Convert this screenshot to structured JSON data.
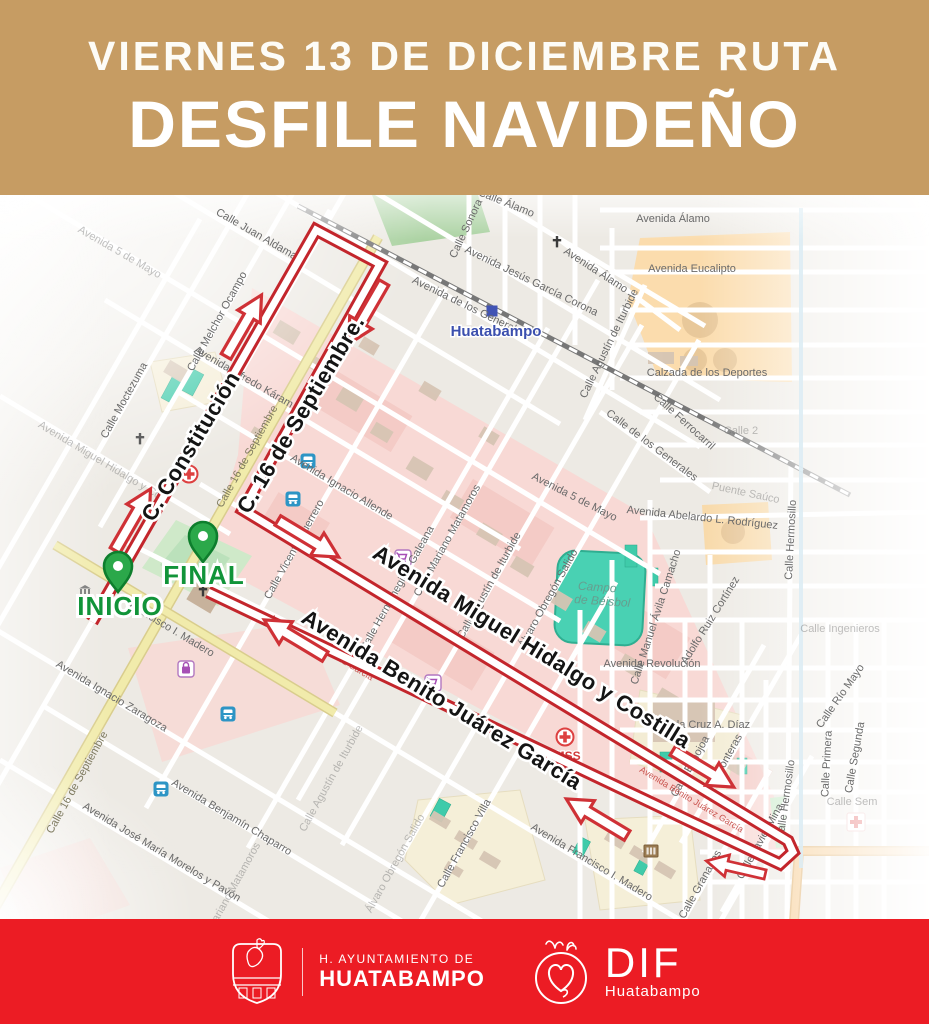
{
  "header": {
    "line1": "VIERNES 13 DE DICIEMBRE RUTA",
    "line2": "DESFILE NAVIDEÑO",
    "bg_color": "#c69c63",
    "text_color": "#ffffff"
  },
  "footer": {
    "bg_color": "#ec1c24",
    "ayuntamiento_line1": "H. AYUNTAMIENTO DE",
    "ayuntamiento_line2": "HUATABAMPO",
    "dif_label": "DIF",
    "dif_sub": "Huatabampo"
  },
  "map": {
    "route": {
      "color": "#c3262c",
      "points": [
        [
          92,
          622
        ],
        [
          316,
          230
        ],
        [
          380,
          264
        ],
        [
          243,
          510
        ],
        [
          788,
          841
        ],
        [
          793,
          852
        ],
        [
          780,
          864
        ],
        [
          208,
          592
        ]
      ],
      "arrows": [
        {
          "x": 132,
          "y": 521,
          "r": -60
        },
        {
          "x": 243,
          "y": 327,
          "r": -60
        },
        {
          "x": 367,
          "y": 312,
          "r": 120
        },
        {
          "x": 307,
          "y": 538,
          "r": 31
        },
        {
          "x": 702,
          "y": 768,
          "r": 31
        },
        {
          "x": 598,
          "y": 818,
          "r": 211
        },
        {
          "x": 296,
          "y": 639,
          "r": 211
        },
        {
          "x": 737,
          "y": 868,
          "r": 193,
          "s": 0.85
        }
      ]
    },
    "markers": [
      {
        "label": "INICIO",
        "x": 118,
        "y": 592,
        "lx": 120,
        "ly": 615
      },
      {
        "label": "FINAL",
        "x": 203,
        "y": 562,
        "lx": 204,
        "ly": 584
      }
    ],
    "route_labels": [
      {
        "t": "C. Constitución",
        "x": 197,
        "y": 450,
        "r": -59
      },
      {
        "t": "C. 16 de Septiembre.",
        "x": 307,
        "y": 418,
        "r": -59
      },
      {
        "t": "Avenida Miguel Hidalgo y Costilla",
        "x": 528,
        "y": 653,
        "r": 31.5
      },
      {
        "t": "Avenida Benito Juárez García",
        "x": 438,
        "y": 706,
        "r": 31.5
      }
    ],
    "street_labels": [
      {
        "t": "Avenida 5 de Mayo",
        "x": 118,
        "y": 255,
        "r": 30,
        "cls": "sl faint"
      },
      {
        "t": "Calle Juan Aldama",
        "x": 255,
        "y": 237,
        "r": 30,
        "cls": "sl"
      },
      {
        "t": "Calle Melchor Ocampo",
        "x": 220,
        "y": 323,
        "r": -61,
        "cls": "sl"
      },
      {
        "t": "Calle Moctezuma",
        "x": 127,
        "y": 402,
        "r": -61,
        "cls": "sl"
      },
      {
        "t": "Avenida Miguel Hidalgo y Co",
        "x": 98,
        "y": 463,
        "r": 31,
        "cls": "sl faint"
      },
      {
        "t": "Avenida Alfredo Káram",
        "x": 242,
        "y": 380,
        "r": 30,
        "cls": "sl"
      },
      {
        "t": "Calle 16 de Septiembre",
        "x": 250,
        "y": 458,
        "r": -61,
        "cls": "sl yr"
      },
      {
        "t": "Avenida Ignacio Allende",
        "x": 340,
        "y": 490,
        "r": 31,
        "cls": "sl"
      },
      {
        "t": "Calle Vicente Guerrero",
        "x": 297,
        "y": 551,
        "r": -61,
        "cls": "sl"
      },
      {
        "t": "Calle Hermenegildo Galeana",
        "x": 400,
        "y": 590,
        "r": -61,
        "cls": "sl"
      },
      {
        "t": "Calle Mariano Matamoros",
        "x": 450,
        "y": 542,
        "r": -61,
        "cls": "sl"
      },
      {
        "t": "Calle Agustín de Iturbide",
        "x": 492,
        "y": 587,
        "r": -61,
        "cls": "sl"
      },
      {
        "t": "Álvaro Obregón Salido",
        "x": 551,
        "y": 600,
        "r": -61,
        "cls": "sl"
      },
      {
        "t": "Francisco I. Madero",
        "x": 170,
        "y": 632,
        "r": 31,
        "cls": "sl"
      },
      {
        "t": "Avenida Ignacio Zaragoza",
        "x": 110,
        "y": 699,
        "r": 31,
        "cls": "sl"
      },
      {
        "t": "Calle 16 de Septiembre",
        "x": 80,
        "y": 784,
        "r": -61,
        "cls": "sl yr"
      },
      {
        "t": "Avenida Benjamín Chaparro",
        "x": 230,
        "y": 820,
        "r": 31,
        "cls": "sl"
      },
      {
        "t": "Avenida José María Morelos y Pavón",
        "x": 160,
        "y": 855,
        "r": 31,
        "cls": "sl"
      },
      {
        "t": "Calle Mariano Matamoros",
        "x": 230,
        "y": 900,
        "r": -61,
        "cls": "sl faint"
      },
      {
        "t": "Calle Francisco Villa",
        "x": 467,
        "y": 845,
        "r": -61,
        "cls": "sl"
      },
      {
        "t": "Álvaro Obregón Salido",
        "x": 398,
        "y": 865,
        "r": -61,
        "cls": "sl faint"
      },
      {
        "t": "Calle Agustín de Iturbide",
        "x": 334,
        "y": 780,
        "r": -61,
        "cls": "sl faint"
      },
      {
        "t": "Avenida Francisco I. Madero",
        "x": 590,
        "y": 865,
        "r": 31,
        "cls": "sl"
      },
      {
        "t": "Calle Granados",
        "x": 703,
        "y": 886,
        "r": -61,
        "cls": "sl"
      },
      {
        "t": "Calle Javier Mina",
        "x": 763,
        "y": 843,
        "r": -61,
        "cls": "sl"
      },
      {
        "t": "Calle Echojoa",
        "x": 693,
        "y": 768,
        "r": -61,
        "cls": "sl"
      },
      {
        "t": "Fronteras",
        "x": 731,
        "y": 757,
        "r": -61,
        "cls": "sl"
      },
      {
        "t": "Calle Álamo",
        "x": 505,
        "y": 206,
        "r": 22,
        "cls": "sl"
      },
      {
        "t": "Calle Sonora",
        "x": 469,
        "y": 230,
        "r": -65,
        "cls": "sl"
      },
      {
        "t": "Avenida Jesús García Corona",
        "x": 530,
        "y": 284,
        "r": 26,
        "cls": "sl"
      },
      {
        "t": "Avenida de los Generales",
        "x": 468,
        "y": 310,
        "r": 26,
        "cls": "sl"
      },
      {
        "t": "Avenida Álamo",
        "x": 594,
        "y": 273,
        "r": 33,
        "cls": "sl"
      },
      {
        "t": "Avenida Álamo",
        "x": 673,
        "y": 222,
        "r": 0,
        "cls": "sl"
      },
      {
        "t": "Avenida Eucalipto",
        "x": 692,
        "y": 272,
        "r": 0,
        "cls": "sl"
      },
      {
        "t": "Calle Agustín de Iturbide",
        "x": 612,
        "y": 345,
        "r": -64,
        "cls": "sl"
      },
      {
        "t": "Calzada de los Deportes",
        "x": 707,
        "y": 376,
        "r": 0,
        "cls": "sl"
      },
      {
        "t": "Calle Ferrocarril",
        "x": 682,
        "y": 424,
        "r": 42,
        "cls": "sl"
      },
      {
        "t": "Calle de los Generales",
        "x": 650,
        "y": 448,
        "r": 37,
        "cls": "sl"
      },
      {
        "t": "Avenida 5 de Mayo",
        "x": 573,
        "y": 500,
        "r": 27,
        "cls": "sl"
      },
      {
        "t": "Avenida Abelardo L. Rodríguez",
        "x": 702,
        "y": 521,
        "r": 6,
        "cls": "sl"
      },
      {
        "t": "Puente Saúco",
        "x": 745,
        "y": 496,
        "r": 12,
        "cls": "sl faint"
      },
      {
        "t": "Campo",
        "x": 597,
        "y": 591,
        "r": 4,
        "cls": "campo"
      },
      {
        "t": "de Béisbol",
        "x": 602,
        "y": 605,
        "r": 4,
        "cls": "campo"
      },
      {
        "t": "Calle Manuel Ávila Camacho",
        "x": 659,
        "y": 618,
        "r": -72,
        "cls": "sl"
      },
      {
        "t": "Adolfo Ruiz Cortínez",
        "x": 713,
        "y": 622,
        "r": -58,
        "cls": "sl"
      },
      {
        "t": "Avenida Revolución",
        "x": 652,
        "y": 667,
        "r": 0,
        "cls": "sl"
      },
      {
        "t": "Avenida Cruz A. Díaz",
        "x": 698,
        "y": 728,
        "r": 0,
        "cls": "sl"
      },
      {
        "t": "Calle Hermosillo",
        "x": 794,
        "y": 540,
        "r": -87,
        "cls": "sl"
      },
      {
        "t": "Calle Hermosillo",
        "x": 789,
        "y": 800,
        "r": -82,
        "cls": "sl"
      },
      {
        "t": "Calle Primera",
        "x": 830,
        "y": 764,
        "r": -87,
        "cls": "sl"
      },
      {
        "t": "Calle Segunda",
        "x": 858,
        "y": 758,
        "r": -80,
        "cls": "sl"
      },
      {
        "t": "Calle Río Mayo",
        "x": 843,
        "y": 698,
        "r": -55,
        "cls": "sl"
      },
      {
        "t": "Calle Ingenieros",
        "x": 840,
        "y": 632,
        "r": 0,
        "cls": "sl faint"
      },
      {
        "t": "Calle Sem",
        "x": 852,
        "y": 805,
        "r": 0,
        "cls": "sl faint"
      },
      {
        "t": "Calle 2",
        "x": 741,
        "y": 434,
        "r": 0,
        "cls": "sl faint"
      },
      {
        "t": "Huatabampo",
        "x": 496,
        "y": 336,
        "r": 0,
        "cls": "town"
      },
      {
        "t": "IMSS",
        "x": 566,
        "y": 760,
        "r": 0,
        "cls": "imss"
      },
      {
        "t": "Avenida Benito Juárez García",
        "x": 320,
        "y": 650,
        "r": 31,
        "cls": "redroad"
      },
      {
        "t": "Avenida Benito Juárez García",
        "x": 690,
        "y": 802,
        "r": 31,
        "cls": "redroad"
      }
    ],
    "icons": [
      {
        "type": "bus",
        "x": 308,
        "y": 461
      },
      {
        "type": "bus",
        "x": 293,
        "y": 499
      },
      {
        "type": "bus",
        "x": 228,
        "y": 714
      },
      {
        "type": "bus",
        "x": 161,
        "y": 789
      },
      {
        "type": "cart",
        "x": 403,
        "y": 558
      },
      {
        "type": "cart",
        "x": 433,
        "y": 683
      },
      {
        "type": "bag",
        "x": 186,
        "y": 669
      },
      {
        "type": "medcross",
        "x": 189,
        "y": 474
      },
      {
        "type": "medcross",
        "x": 565,
        "y": 737
      },
      {
        "type": "hospital",
        "x": 856,
        "y": 822
      },
      {
        "type": "museum",
        "x": 85,
        "y": 591
      },
      {
        "type": "church",
        "x": 557,
        "y": 243
      },
      {
        "type": "church",
        "x": 140,
        "y": 440
      },
      {
        "type": "church",
        "x": 203,
        "y": 592
      },
      {
        "type": "bank",
        "x": 651,
        "y": 851
      },
      {
        "type": "townsq",
        "x": 492,
        "y": 311
      }
    ]
  }
}
